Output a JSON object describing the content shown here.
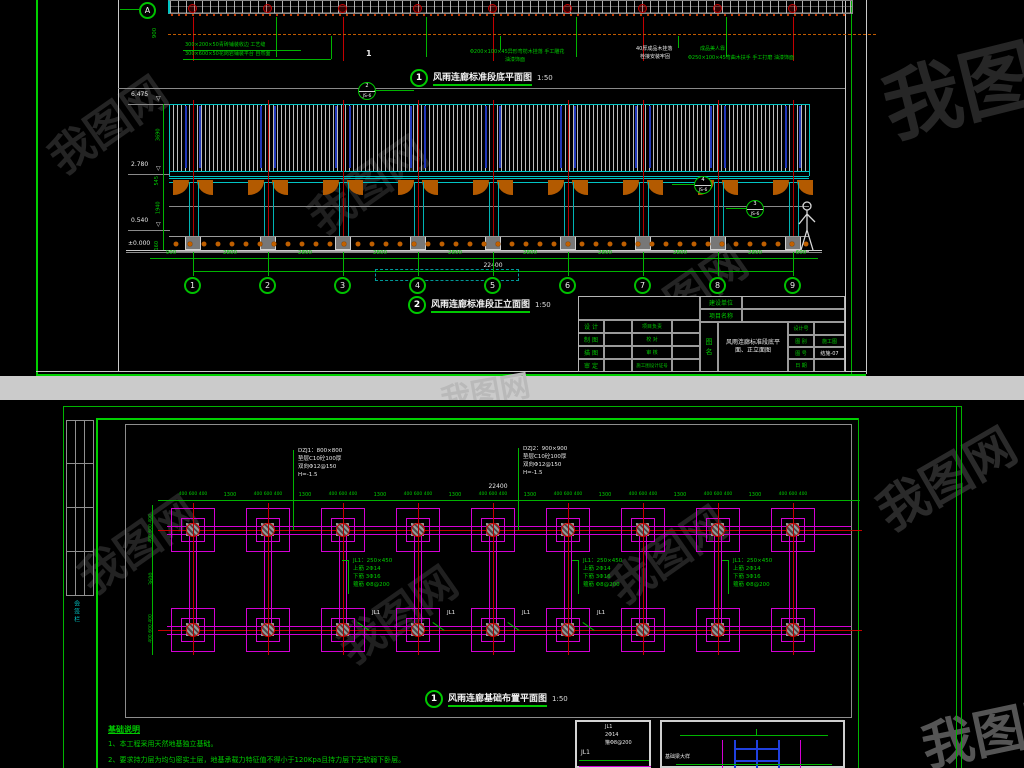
{
  "watermark": {
    "brand": "我图网"
  },
  "top_panel": {
    "plan": {
      "grid_bubble": "A",
      "vertical_dim": "900",
      "section_mark": "1",
      "notes": {
        "n1a": "300×200×50青砖铺装收边 工艺缝",
        "n1b": "300×600×50花岗岩铺装平台 自然面",
        "n2a": "Φ200×100×45异形弯枋木挂落 手工雕花",
        "n2b": "油漆饰面",
        "n3a": "40厚成品木挂落",
        "n3b": "栓接安装牢固",
        "n4a": "成品美人靠",
        "n4b": "Φ250×100×45弯曲木扶手 手工打磨 油漆饰面"
      },
      "title": {
        "num": "1",
        "text": "风雨连廊标准段底平面图",
        "scale": "1:50"
      }
    },
    "elevation": {
      "levels": {
        "top": "6.475",
        "eave": "2.780",
        "rail": "0.540",
        "ground": "±0.000"
      },
      "vdims": [
        "3690",
        "545",
        "1940",
        "160"
      ],
      "grid_labels": [
        "1",
        "2",
        "3",
        "4",
        "5",
        "6",
        "7",
        "8",
        "9"
      ],
      "dim_left": "900",
      "dim_bay": "2800",
      "dim_right": "600",
      "dim_total": "22400",
      "callouts": [
        {
          "num": "2",
          "sheet": "JS-6"
        },
        {
          "num": "4",
          "sheet": "JS-6"
        },
        {
          "num": "3",
          "sheet": "JS-6"
        }
      ],
      "title": {
        "num": "2",
        "text": "风雨连廊标准段正立面图",
        "scale": "1:50"
      }
    },
    "title_block": {
      "owner_label": "建设单位",
      "project_label": "项目名称",
      "fig_label": "图\n名",
      "fig_name": "风雨连廊标准段底平面、正立面图",
      "left_rows": [
        {
          "l1": "设 计",
          "l2": "项目负责"
        },
        {
          "l1": "制 图",
          "l2": "校 对"
        },
        {
          "l1": "描 图",
          "l2": "审 核"
        },
        {
          "l1": "审 定",
          "l2": "施工图设计证号"
        }
      ],
      "right_rows": [
        {
          "label": "设计号",
          "value": ""
        },
        {
          "label": "图 别",
          "value": "施工图"
        },
        {
          "label": "图 号",
          "value": "结施-07"
        },
        {
          "label": "日 期",
          "value": ""
        }
      ]
    }
  },
  "bottom_panel": {
    "sign_strip_label": "会签栏",
    "plan": {
      "dim_total": "22400",
      "dim_footing": "400 600 400",
      "dim_bay": "1300",
      "left_dim_footing": "400 600 400",
      "left_dim_span": "3600",
      "footing_note_1": [
        "DZJ1：800×800",
        "垫层C10砼100厚",
        "双向Φ12@150",
        "H=-1.5"
      ],
      "footing_note_2": [
        "DZJ2：900×900",
        "垫层C10砼100厚",
        "双向Φ12@150",
        "H=-1.5"
      ],
      "beam_note": [
        "JL1：250×450",
        "上筋 2Φ14",
        "下筋 3Φ16",
        "箍筋 Φ8@200"
      ],
      "beam_tag": "JL1",
      "title": {
        "num": "1",
        "text": "风雨连廊基础布置平面图",
        "scale": "1:50"
      }
    },
    "notes": {
      "heading": "基础说明",
      "item1": "1、本工程采用天然地基独立基础。",
      "item2": "2、要求持力层为均匀密实土层，地基承载力特征值不得小于120Kpa且持力层下无软弱下卧层。"
    },
    "detail1": {
      "line1": "JL1",
      "line2": "2Φ14",
      "line3": "箍Φ8@200",
      "tag": "JL1"
    },
    "detail2": {
      "label": "基础梁大样"
    }
  }
}
